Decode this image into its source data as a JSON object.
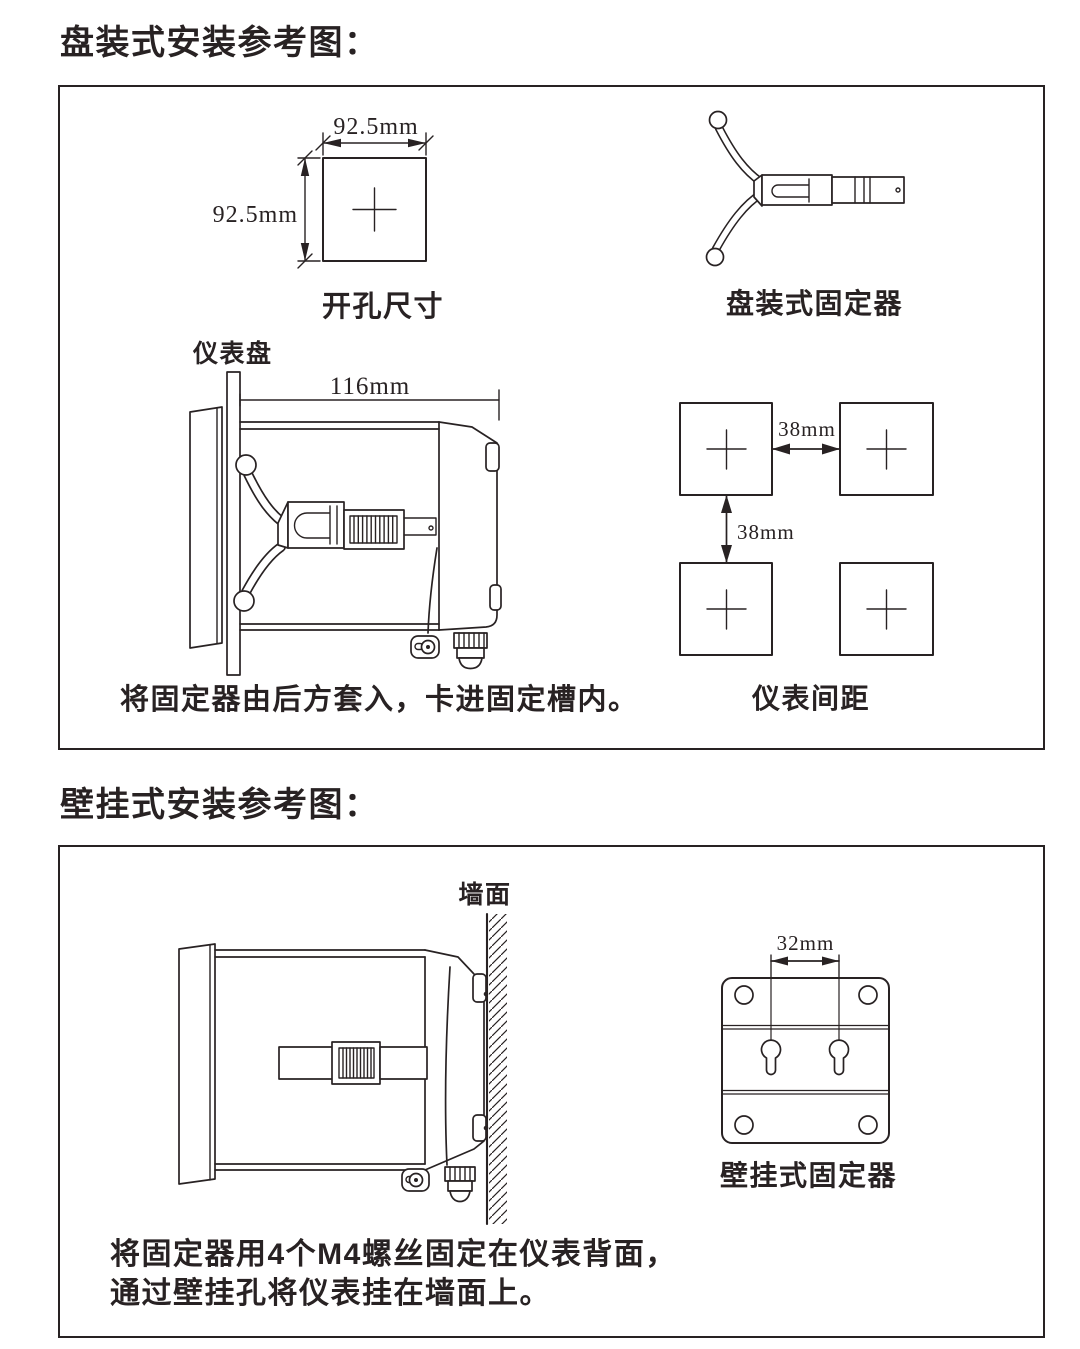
{
  "colors": {
    "ink": "#282223",
    "paper": "#ffffff"
  },
  "panel_section": {
    "title": "盘装式安装参考图：",
    "cutout": {
      "width_label": "92.5mm",
      "height_label": "92.5mm",
      "caption": "开孔尺寸"
    },
    "panel_fixer": {
      "caption": "盘装式固定器"
    },
    "side_view": {
      "panel_label": "仪表盘",
      "depth_label": "116mm",
      "caption": "将固定器由后方套入，卡进固定槽内。"
    },
    "spacing": {
      "horizontal_label": "38mm",
      "vertical_label": "38mm",
      "caption": "仪表间距"
    }
  },
  "wall_section": {
    "title": "壁挂式安装参考图：",
    "side_view": {
      "wall_label": "墙面"
    },
    "wall_fixer": {
      "dim_label": "32mm",
      "caption": "壁挂式固定器"
    },
    "caption_line1": "将固定器用4个M4螺丝固定在仪表背面，",
    "caption_line2": "通过壁挂孔将仪表挂在墙面上。"
  }
}
